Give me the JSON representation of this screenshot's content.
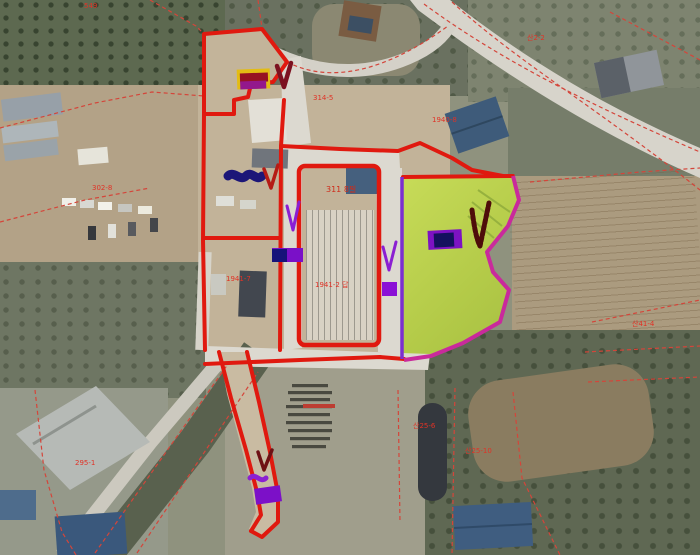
{
  "map": {
    "type": "aerial-cadastral-map",
    "labels": [
      {
        "text": "549"
      },
      {
        "text": "산2-2"
      },
      {
        "text": "314-5"
      },
      {
        "text": "311 8필"
      },
      {
        "text": "1941-2 답"
      },
      {
        "text": "1941-7"
      },
      {
        "text": "1940-8"
      },
      {
        "text": "302-8"
      },
      {
        "text": "산41-4"
      },
      {
        "text": "295-1"
      },
      {
        "text": "산25-6"
      },
      {
        "text": "산25-10"
      }
    ],
    "colors": {
      "parcel_boundary_red": "#e0190f",
      "cadastral_dashed_red": "#d4453a",
      "highlight_green": "#bcd24f",
      "boundary_magenta": "#c92a9c",
      "boundary_purple": "#7b2fd0",
      "annotation_purple": "#8b1fd2",
      "annotation_navy": "#1c1678",
      "annotation_maroon": "#7c1120",
      "annotation_yellow": "#e3bc14",
      "label_red": "#e03226"
    },
    "annotations": [
      "highlight-bar",
      "check-marks",
      "scribbles",
      "handwritten-note-block"
    ]
  }
}
